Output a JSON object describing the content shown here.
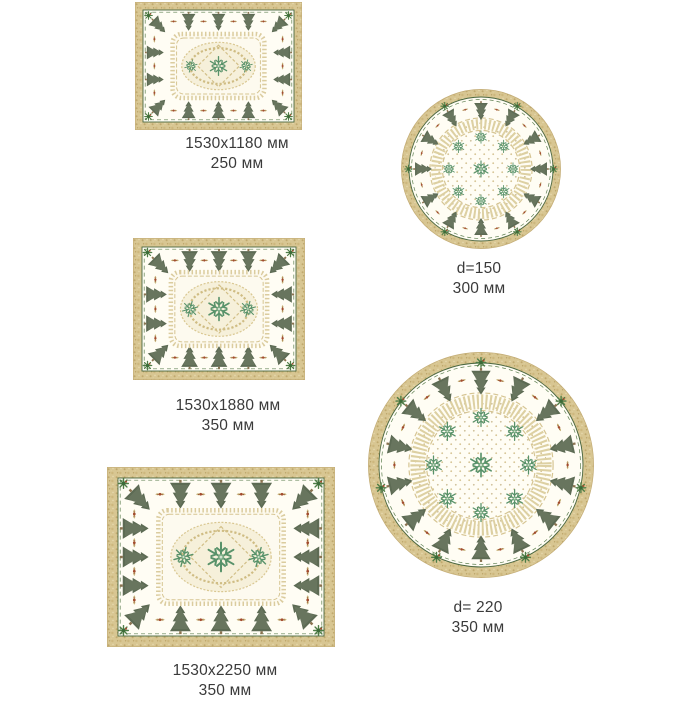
{
  "page": {
    "kind": "tablecloth catalog sheet",
    "background": "#ffffff"
  },
  "palette": {
    "border_tan": "#d8c692",
    "border_speckle": "#c0a96e",
    "field_ivory": "#fffdf4",
    "scallop_green": "#49663f",
    "tree_green": "#5d6b54",
    "tree_light": "#75836a",
    "trunk_brown": "#8a7350",
    "lace_gold": "#dbcc9e",
    "flake_green": "#58926a",
    "berry_red": "#a34b2e",
    "caption_text": "#3a3a3a"
  },
  "design_motifs": [
    "christmas-tree",
    "snowflake",
    "holly-star",
    "ribbon-ornament",
    "lace-medallion",
    "dotted-center"
  ],
  "products": [
    {
      "shape": "rectangle",
      "label_line1": "1530x1180 мм",
      "label_line2": "250 мм"
    },
    {
      "shape": "round",
      "label_line1": "d=150",
      "label_line2": "300 мм"
    },
    {
      "shape": "rectangle",
      "label_line1": "1530x1880 мм",
      "label_line2": "350 мм"
    },
    {
      "shape": "rectangle",
      "label_line1": "1530x2250 мм",
      "label_line2": "350 мм"
    },
    {
      "shape": "round",
      "label_line1": "d= 220",
      "label_line2": "350 мм"
    }
  ]
}
